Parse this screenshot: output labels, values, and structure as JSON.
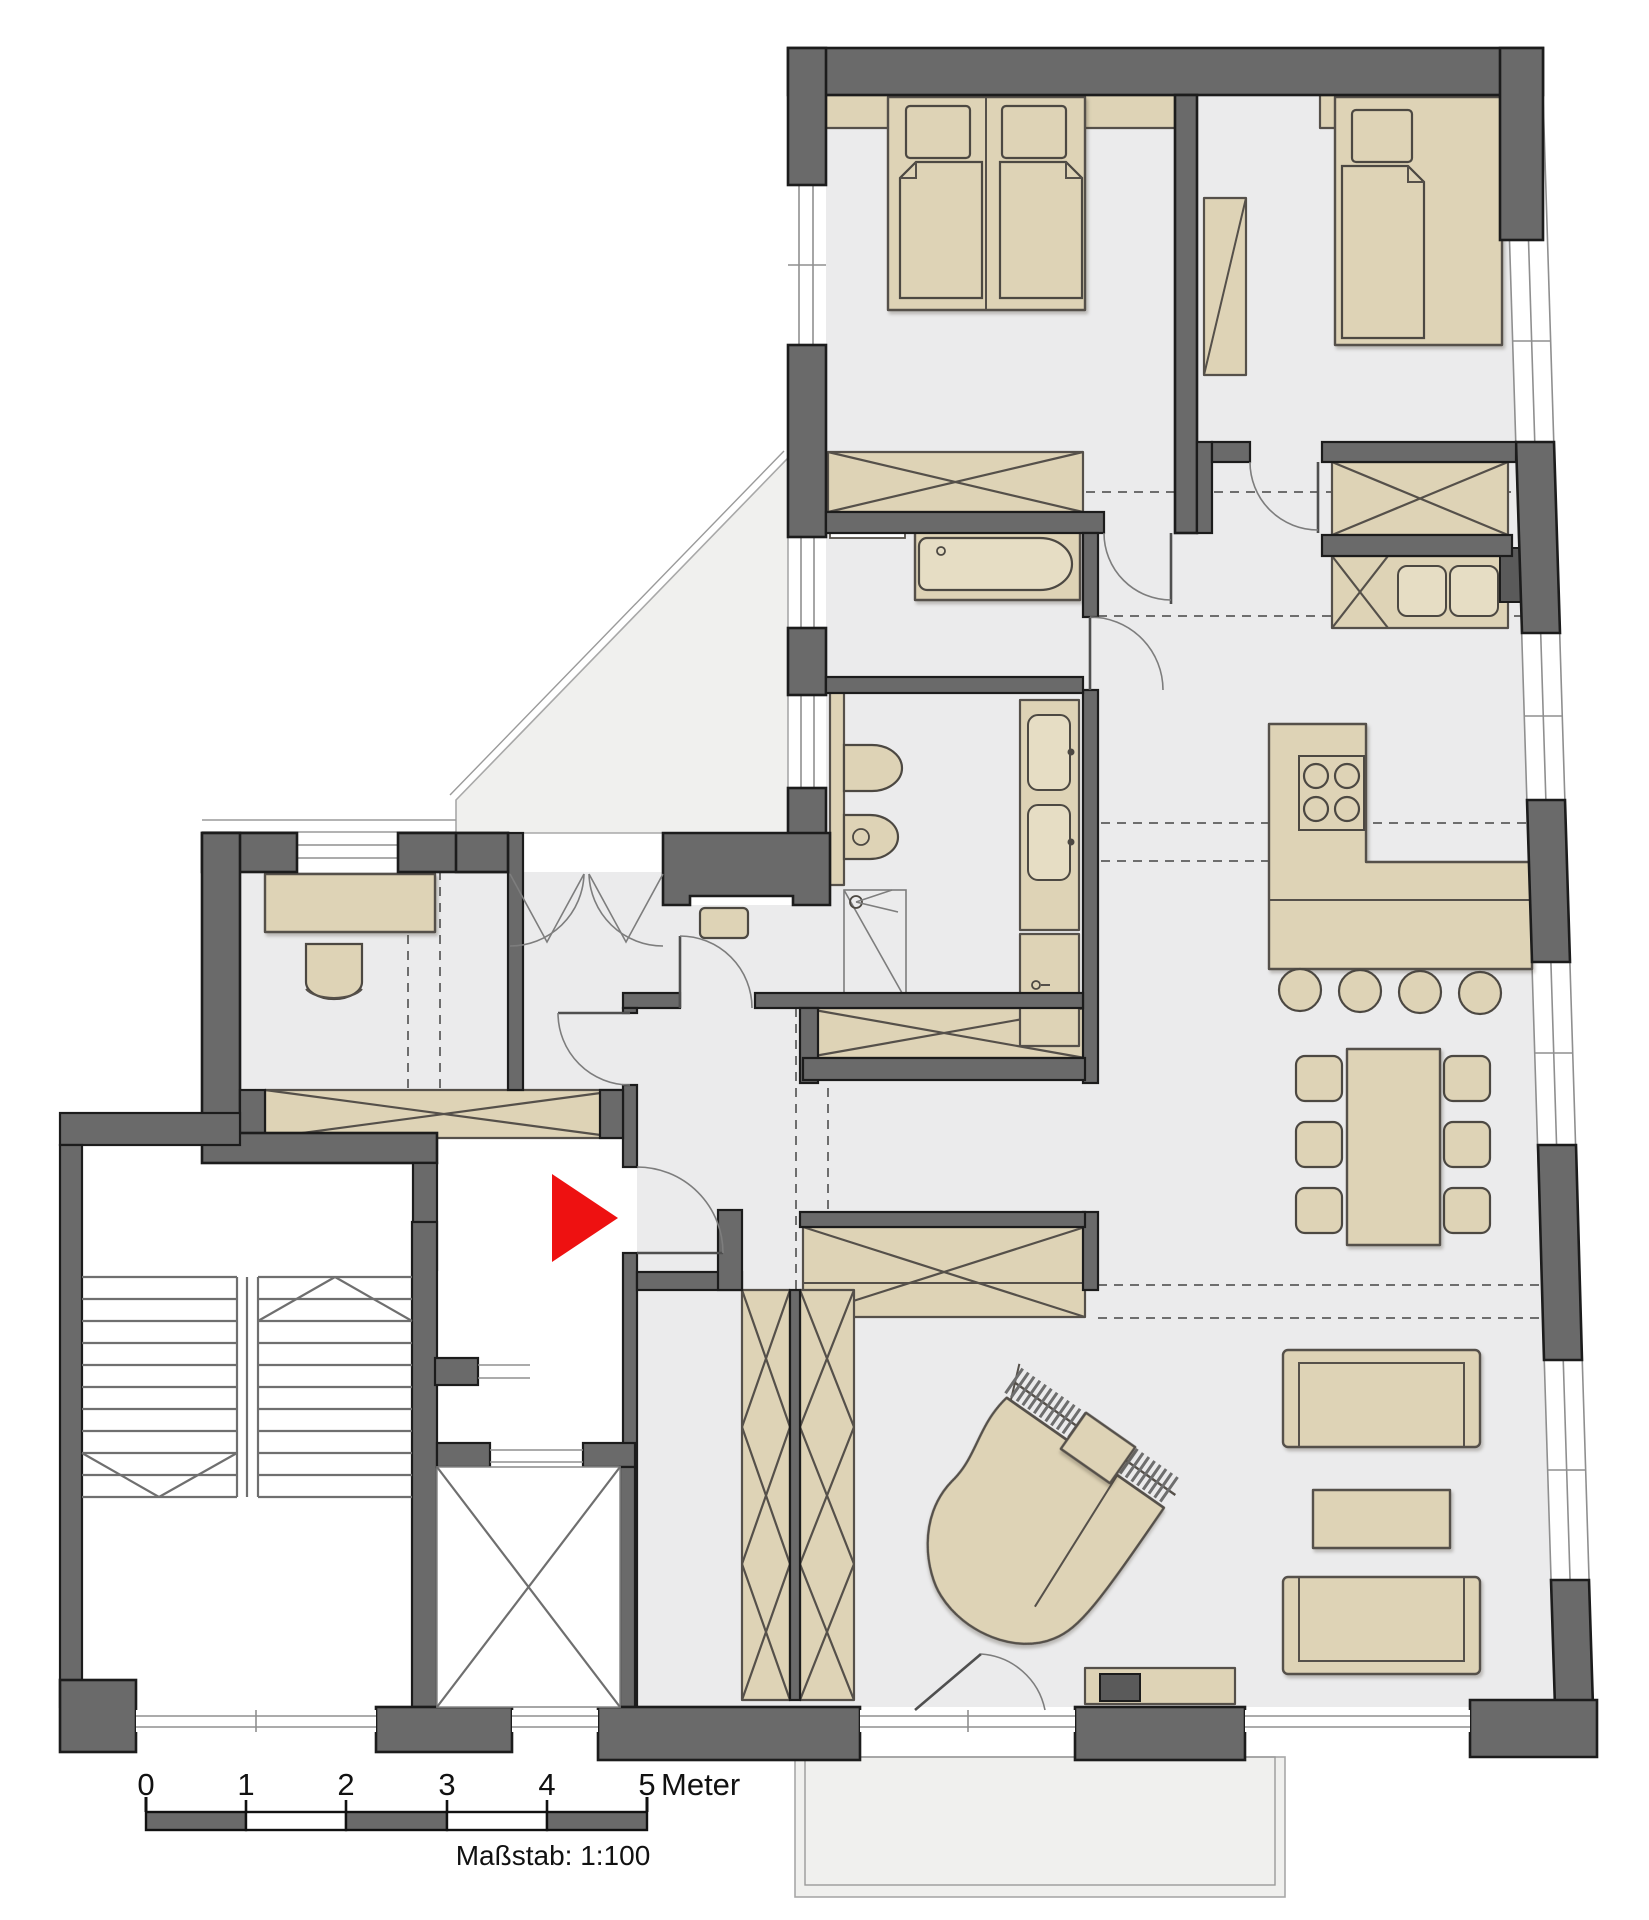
{
  "scale_bar": {
    "ticks": [
      "0",
      "1",
      "2",
      "3",
      "4",
      "5"
    ],
    "unit": "Meter",
    "caption": "Maßstab: 1:100"
  },
  "plan": {
    "type": "apartment-floor-plan",
    "entrance_marker": "red-arrow-east",
    "rooms_depicted": [
      "bedroom-1",
      "bedroom-2",
      "bathroom",
      "shower-wc",
      "kitchen",
      "dining-area",
      "living-room",
      "office",
      "entry-hall",
      "terrace",
      "balcony",
      "stairwell",
      "elevator"
    ],
    "furniture_depicted": [
      "double-bed",
      "single-bed",
      "desks",
      "wardrobes",
      "bathtub",
      "toilet",
      "bidet",
      "shower",
      "double-vanity",
      "washer",
      "dryer",
      "kitchen-counter-with-hob",
      "bar-stools",
      "dining-table-6-chairs",
      "grand-piano",
      "piano-bench",
      "two-sofas",
      "coffee-table",
      "sideboard-tv"
    ]
  },
  "colors": {
    "wall": "#6a6a6a",
    "wall_outline": "#1c1c1c",
    "floor": "#ebebec",
    "furniture": "#ded3b6",
    "terrace": "#f0f0ee",
    "entrance_arrow": "#ee1111",
    "background": "#ffffff"
  }
}
